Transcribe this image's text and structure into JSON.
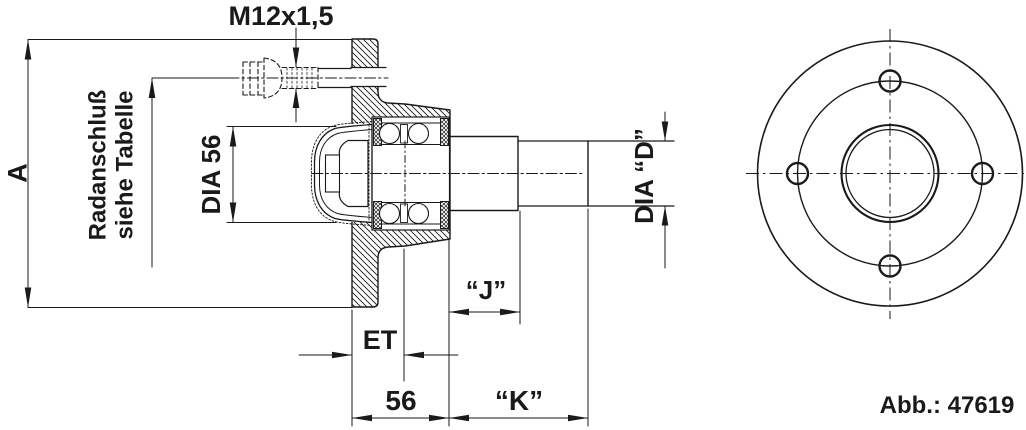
{
  "figure": {
    "number": "Abb.: 47619",
    "labels": {
      "thread": "M12x1,5",
      "overall_dia": "A",
      "wheel_mount_1": "Radanschluß",
      "wheel_mount_2": "siehe Tabelle",
      "cap_dia": "DIA 56",
      "spindle_dia": "DIA “D”",
      "offset": "ET",
      "dim_j": "“J”",
      "hub_width": "56",
      "dim_k": "“K”"
    },
    "colors": {
      "line": "#1a1a1a",
      "background": "#ffffff"
    }
  }
}
